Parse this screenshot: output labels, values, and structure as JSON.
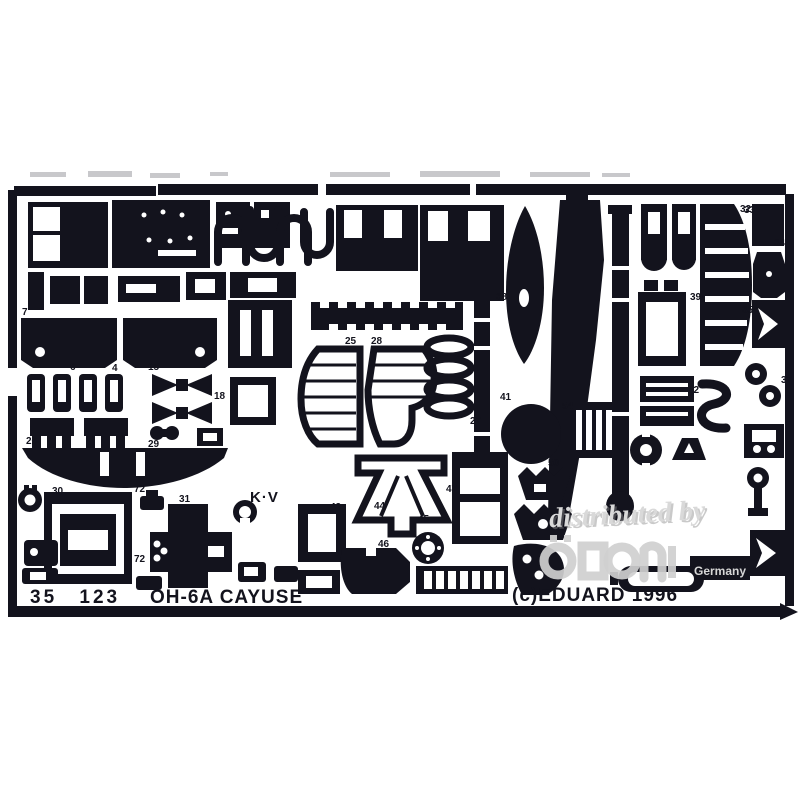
{
  "product": {
    "catalog_number": "35 123",
    "subject": "OH-6A CAYUSE",
    "copyright": "(c)EDUARD 1996",
    "etched_marking": "K·V"
  },
  "watermark": {
    "line": "distributed by",
    "country": "Germany"
  },
  "colors": {
    "fret": "#13131d",
    "background": "#ffffff",
    "watermark_light": "#d9d9d9",
    "watermark_shadow": "#8a8a8a"
  },
  "part_labels": [
    {
      "n": "7",
      "x": 22,
      "y": 315
    },
    {
      "n": "4",
      "x": 112,
      "y": 371
    },
    {
      "n": "6",
      "x": 70,
      "y": 370
    },
    {
      "n": "15",
      "x": 148,
      "y": 370
    },
    {
      "n": "18",
      "x": 214,
      "y": 399
    },
    {
      "n": "29",
      "x": 148,
      "y": 447
    },
    {
      "n": "26",
      "x": 26,
      "y": 444
    },
    {
      "n": "30",
      "x": 52,
      "y": 494
    },
    {
      "n": "31",
      "x": 179,
      "y": 502
    },
    {
      "n": "72",
      "x": 134,
      "y": 492
    },
    {
      "n": "72",
      "x": 134,
      "y": 562
    },
    {
      "n": "25",
      "x": 345,
      "y": 344
    },
    {
      "n": "28",
      "x": 371,
      "y": 344
    },
    {
      "n": "27",
      "x": 470,
      "y": 424
    },
    {
      "n": "38",
      "x": 496,
      "y": 300
    },
    {
      "n": "41",
      "x": 500,
      "y": 400
    },
    {
      "n": "43",
      "x": 330,
      "y": 510
    },
    {
      "n": "44",
      "x": 374,
      "y": 509
    },
    {
      "n": "45",
      "x": 418,
      "y": 522
    },
    {
      "n": "46",
      "x": 378,
      "y": 547
    },
    {
      "n": "47",
      "x": 446,
      "y": 492
    },
    {
      "n": "50",
      "x": 548,
      "y": 466
    },
    {
      "n": "54",
      "x": 562,
      "y": 409
    },
    {
      "n": "42",
      "x": 688,
      "y": 393
    },
    {
      "n": "39",
      "x": 690,
      "y": 300
    },
    {
      "n": "32",
      "x": 740,
      "y": 212
    },
    {
      "n": "33",
      "x": 744,
      "y": 213
    },
    {
      "n": "34",
      "x": 774,
      "y": 246
    },
    {
      "n": "35",
      "x": 742,
      "y": 313
    },
    {
      "n": "37",
      "x": 781,
      "y": 383
    }
  ]
}
